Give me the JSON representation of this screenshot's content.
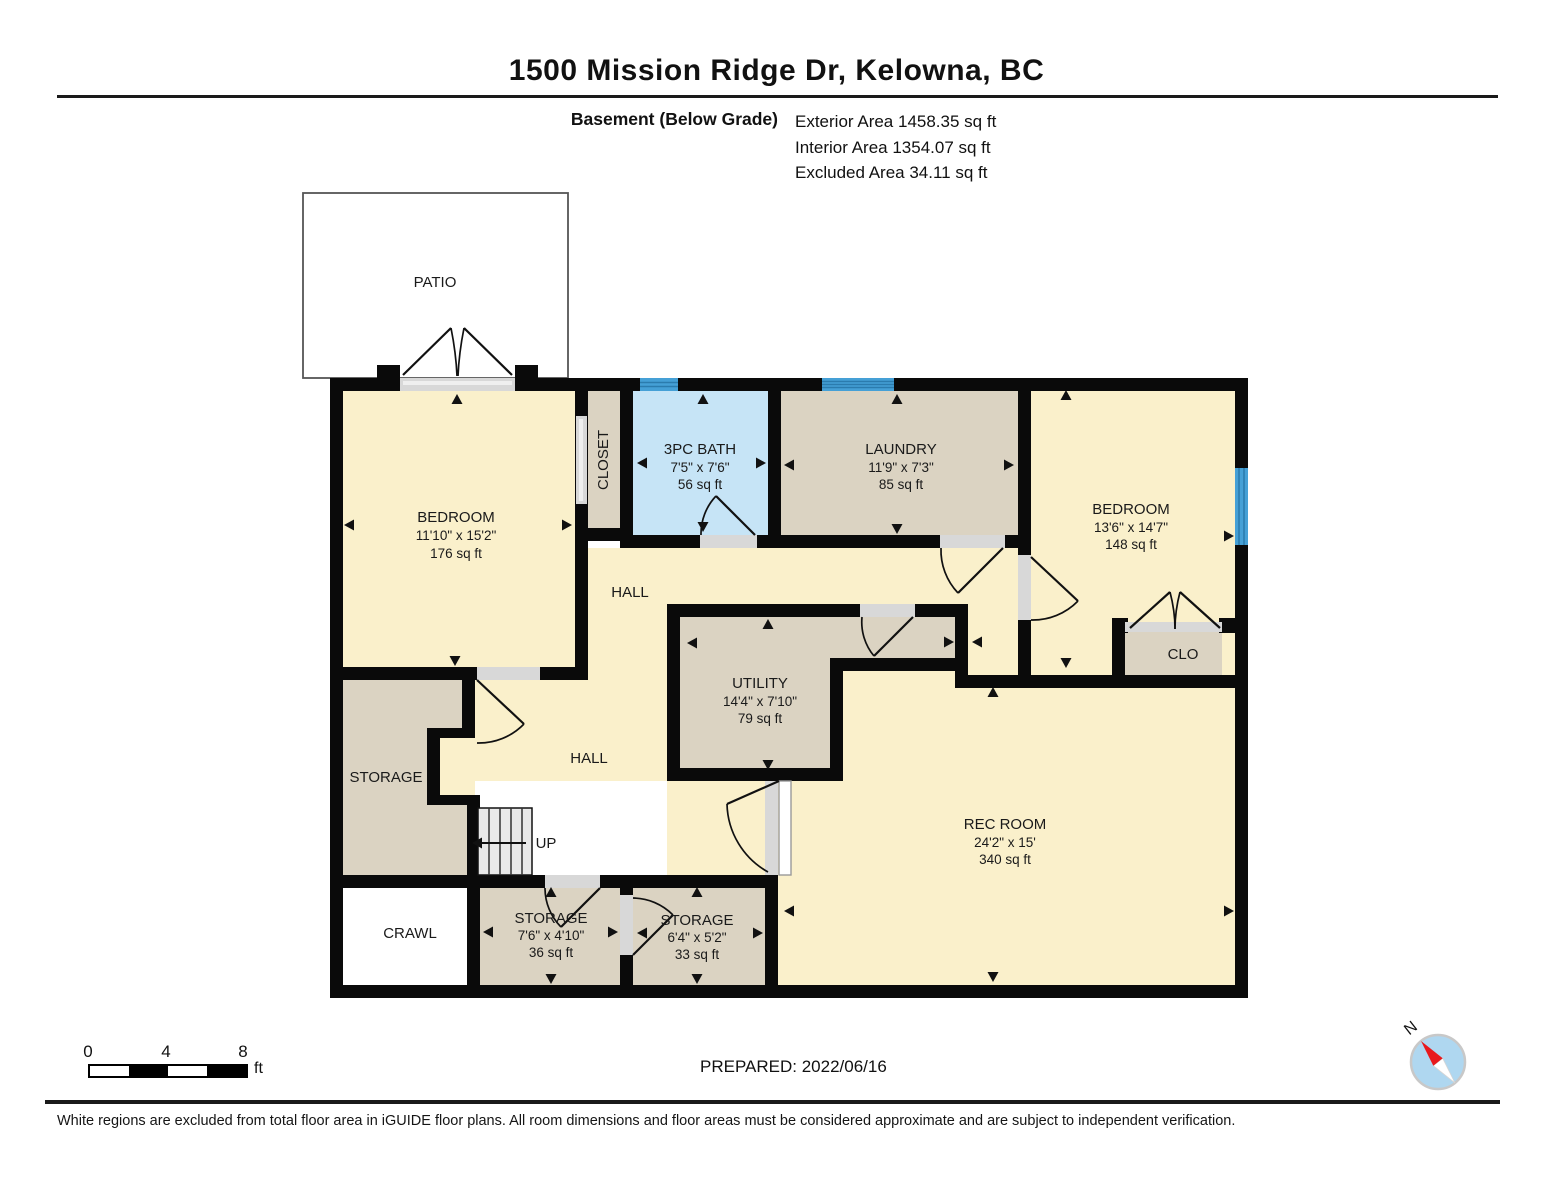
{
  "header": {
    "title": "1500 Mission Ridge Dr, Kelowna, BC",
    "floor_label": "Basement (Below Grade)",
    "area_lines": [
      "Exterior Area 1458.35 sq ft",
      "Interior Area 1354.07 sq ft",
      "Excluded Area 34.11 sq ft"
    ]
  },
  "rooms": {
    "patio": {
      "name": "PATIO"
    },
    "bedroom_left": {
      "name": "BEDROOM",
      "dims": "11'10\" x 15'2\"",
      "area": "176 sq ft"
    },
    "closet": {
      "name": "CLOSET"
    },
    "bath": {
      "name": "3PC BATH",
      "dims": "7'5\" x 7'6\"",
      "area": "56 sq ft"
    },
    "laundry": {
      "name": "LAUNDRY",
      "dims": "11'9\" x 7'3\"",
      "area": "85 sq ft"
    },
    "bedroom_right": {
      "name": "BEDROOM",
      "dims": "13'6\" x 14'7\"",
      "area": "148 sq ft"
    },
    "hall_upper": {
      "name": "HALL"
    },
    "utility": {
      "name": "UTILITY",
      "dims": "14'4\" x 7'10\"",
      "area": "79 sq ft"
    },
    "clo": {
      "name": "CLO"
    },
    "storage_left": {
      "name": "STORAGE"
    },
    "hall_lower": {
      "name": "HALL"
    },
    "stairs": {
      "label": "UP"
    },
    "crawl": {
      "name": "CRAWL"
    },
    "storage_mid": {
      "name": "STORAGE",
      "dims": "7'6\" x 4'10\"",
      "area": "36 sq ft"
    },
    "storage_right": {
      "name": "STORAGE",
      "dims": "6'4\" x 5'2\"",
      "area": "33 sq ft"
    },
    "rec_room": {
      "name": "REC ROOM",
      "dims": "24'2\" x 15'",
      "area": "340 sq ft"
    }
  },
  "footer": {
    "scale_bar": {
      "ticks": [
        "0",
        "4",
        "8"
      ],
      "unit": "ft"
    },
    "prepared": "PREPARED: 2022/06/16",
    "compass": {
      "north_label": "N"
    },
    "disclaimer": "White regions are excluded from total floor area in iGUIDE floor plans. All room dimensions and floor areas must be considered approximate and are subject to independent verification."
  },
  "colors": {
    "room_cream": "#FAF0CB",
    "room_tan": "#DBD3C2",
    "bath_blue": "#C6E4F6",
    "window_blue": "#45A0D6",
    "window_stripe": "#2B7CAE",
    "sill_gray": "#D8D8D8",
    "stairs_gray": "#E9E9E9",
    "compass_red": "#E8191C",
    "compass_blue": "#AFD7F0"
  }
}
